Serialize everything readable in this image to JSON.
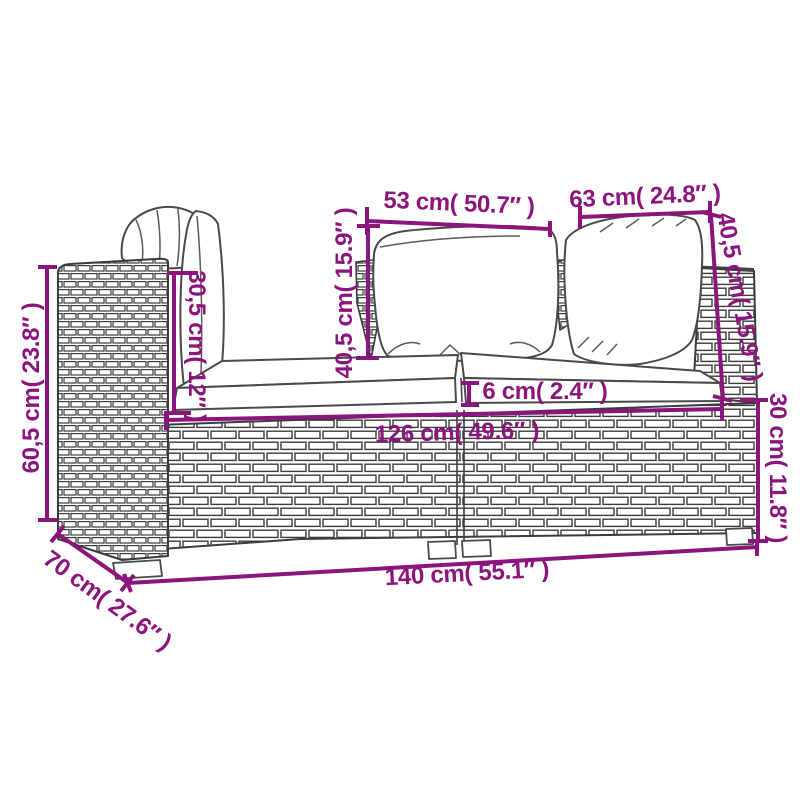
{
  "diagram": {
    "type": "product-dimension-diagram",
    "subject": "2-seater poly rattan garden sofa with back pillows and seat cushions",
    "accent_color": "#8c147d",
    "line_color": "#404040",
    "background": "#ffffff"
  },
  "labels": [
    {
      "id": "back-cushion-width-left",
      "text": "53 cm( 50.7″ )",
      "cm": "53",
      "inch": "50.7"
    },
    {
      "id": "back-cushion-width-right",
      "text": "63 cm( 24.8″ )",
      "cm": "63",
      "inch": "24.8"
    },
    {
      "id": "back-cushion-height-right",
      "text": "40,5 cm( 15.9″ )",
      "cm": "40,5",
      "inch": "15.9"
    },
    {
      "id": "back-cushion-height-middle",
      "text": "40,5 cm( 15.9″ )",
      "cm": "40,5",
      "inch": "15.9"
    },
    {
      "id": "backrest-height-left",
      "text": "30,5 cm( 12″ )",
      "cm": "30,5",
      "inch": "12"
    },
    {
      "id": "total-height-left",
      "text": "60,5 cm( 23.8″ )",
      "cm": "60,5",
      "inch": "23.8"
    },
    {
      "id": "base-height-right",
      "text": "30 cm( 11.8″ )",
      "cm": "30",
      "inch": "11.8"
    },
    {
      "id": "seat-cushion-thickness",
      "text": "6 cm( 2.4″ )",
      "cm": "6",
      "inch": "2.4"
    },
    {
      "id": "seat-width",
      "text": "126 cm( 49.6″ )",
      "cm": "126",
      "inch": "49.6"
    },
    {
      "id": "total-width",
      "text": "140 cm( 55.1″ )",
      "cm": "140",
      "inch": "55.1"
    },
    {
      "id": "depth",
      "text": "70 cm( 27.6″ )",
      "cm": "70",
      "inch": "27.6"
    }
  ]
}
